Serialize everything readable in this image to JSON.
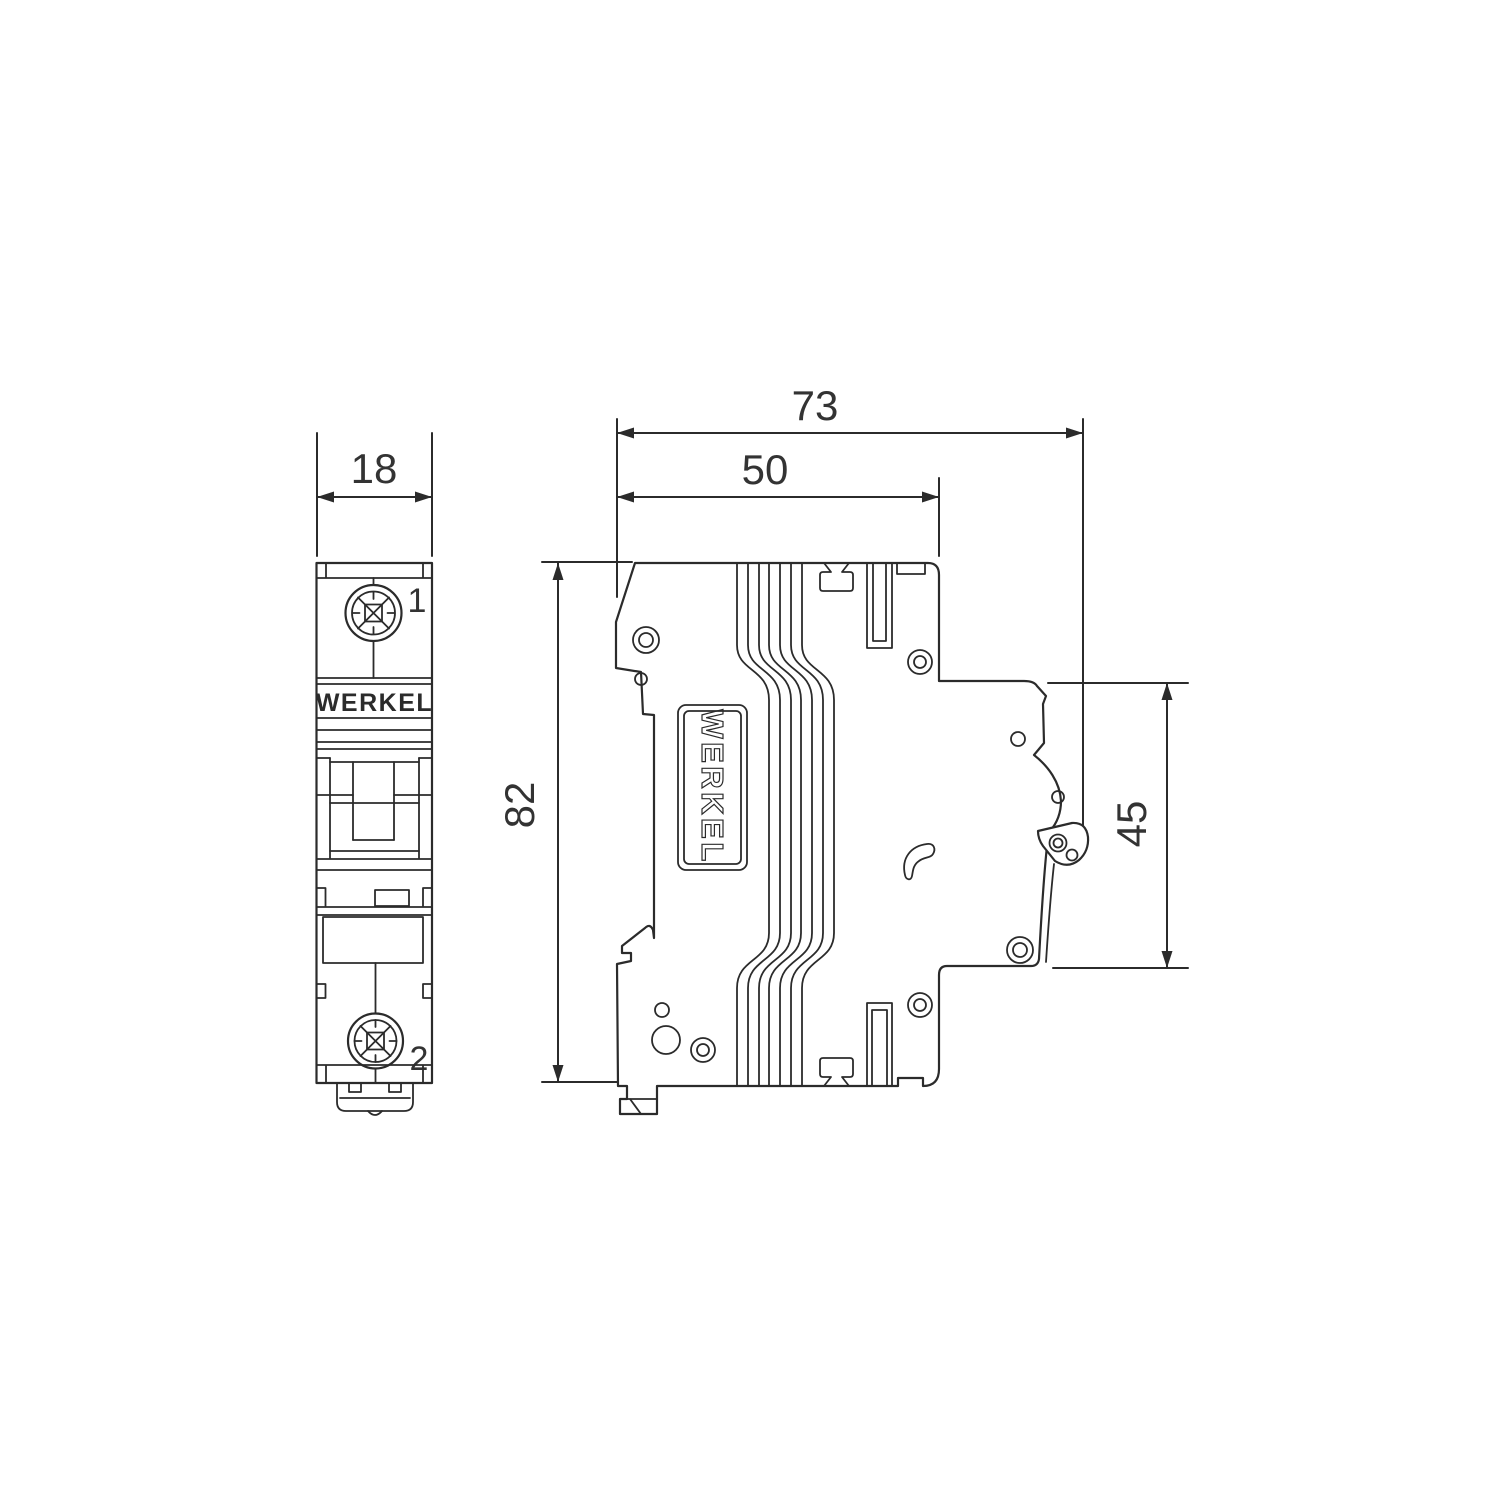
{
  "drawing": {
    "brand": "WERKEL",
    "colors": {
      "line": "#2b2b2b",
      "text": "#333333",
      "background": "#ffffff"
    },
    "front_view": {
      "brand_label": "WERKEL",
      "terminal_top": "1",
      "terminal_bottom": "2"
    },
    "side_view": {
      "brand_label": "WERKEL"
    },
    "dimensions": {
      "front_width_mm": "18",
      "overall_depth_mm": "73",
      "body_depth_mm": "50",
      "height_mm": "82",
      "din_section_mm": "45"
    }
  }
}
